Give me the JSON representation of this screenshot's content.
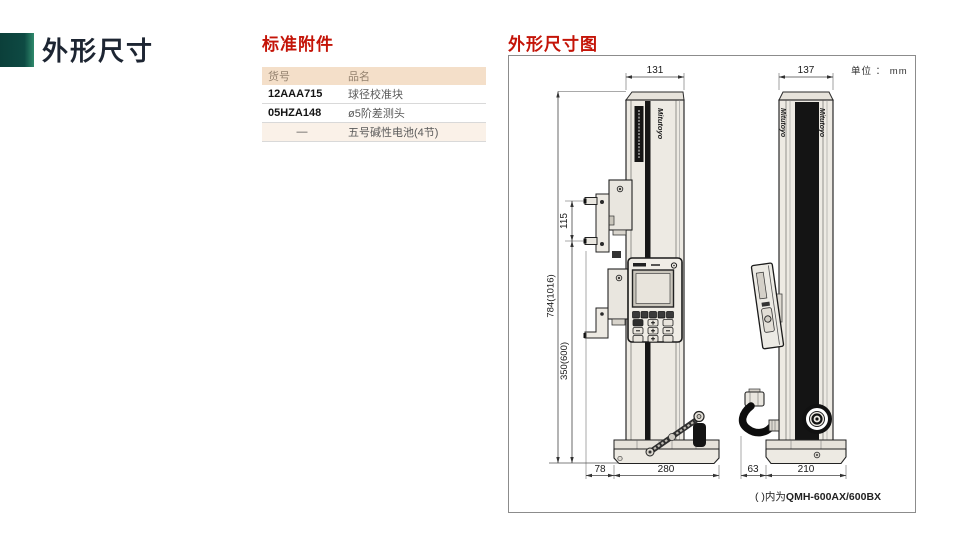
{
  "page": {
    "title": "外形尺寸"
  },
  "accessories": {
    "heading": "标准附件",
    "table": {
      "col_code": "货号",
      "col_name": "品名",
      "rows": [
        {
          "code": "12AAA715",
          "name": "球径校准块"
        },
        {
          "code": "05HZA148",
          "name": "ø5阶差测头"
        },
        {
          "code": "—",
          "name": "五号碱性电池(4节)"
        }
      ]
    }
  },
  "drawing": {
    "heading": "外形尺寸图",
    "unit_label": "单位 ： mm",
    "brand": "Mitutoyo",
    "note": {
      "prefix": "( )内为",
      "model": "QMH-600AX/600BX"
    },
    "dims": {
      "front_width": "131",
      "side_width": "137",
      "probe_span": "115",
      "height": "784(1016)",
      "range": "350(600)",
      "front_offset": "78",
      "front_depth": "280",
      "side_offset": "63",
      "side_depth": "210"
    }
  }
}
